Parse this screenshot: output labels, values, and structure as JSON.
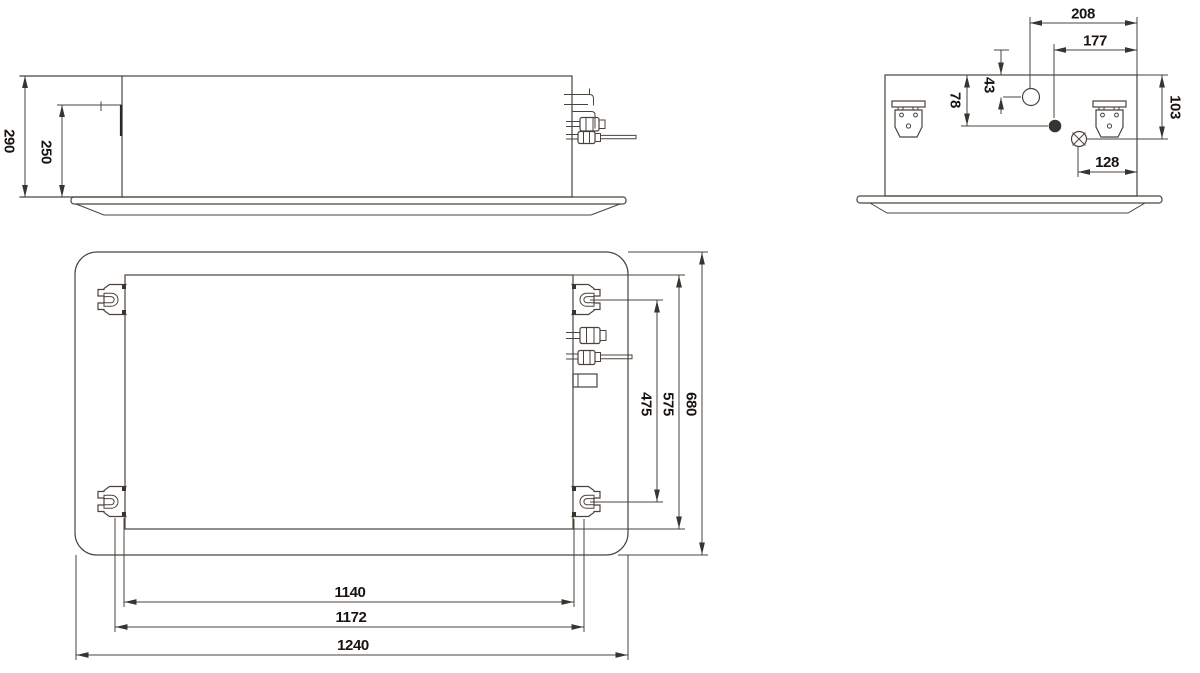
{
  "drawing_type": "technical-dimension-drawing",
  "subject": "ceiling-cassette-unit-three-views",
  "colors": {
    "background": "#ffffff",
    "line": "#4a433c",
    "text": "#191410"
  },
  "views": {
    "front": {
      "dims": {
        "total_height": "290",
        "body_height": "250"
      }
    },
    "side": {
      "dims": {
        "hole_to_edge": "208",
        "dot_to_edge": "177",
        "hole_drop": "43",
        "dot_drop": "78",
        "knockout_drop": "103",
        "knockout_to_edge": "128"
      }
    },
    "plan": {
      "dims": {
        "bracket_pitch_depth": "475",
        "body_depth": "575",
        "panel_depth": "680",
        "bracket_inner_span": "1140",
        "bracket_outer_span": "1172",
        "panel_width": "1240"
      }
    }
  }
}
